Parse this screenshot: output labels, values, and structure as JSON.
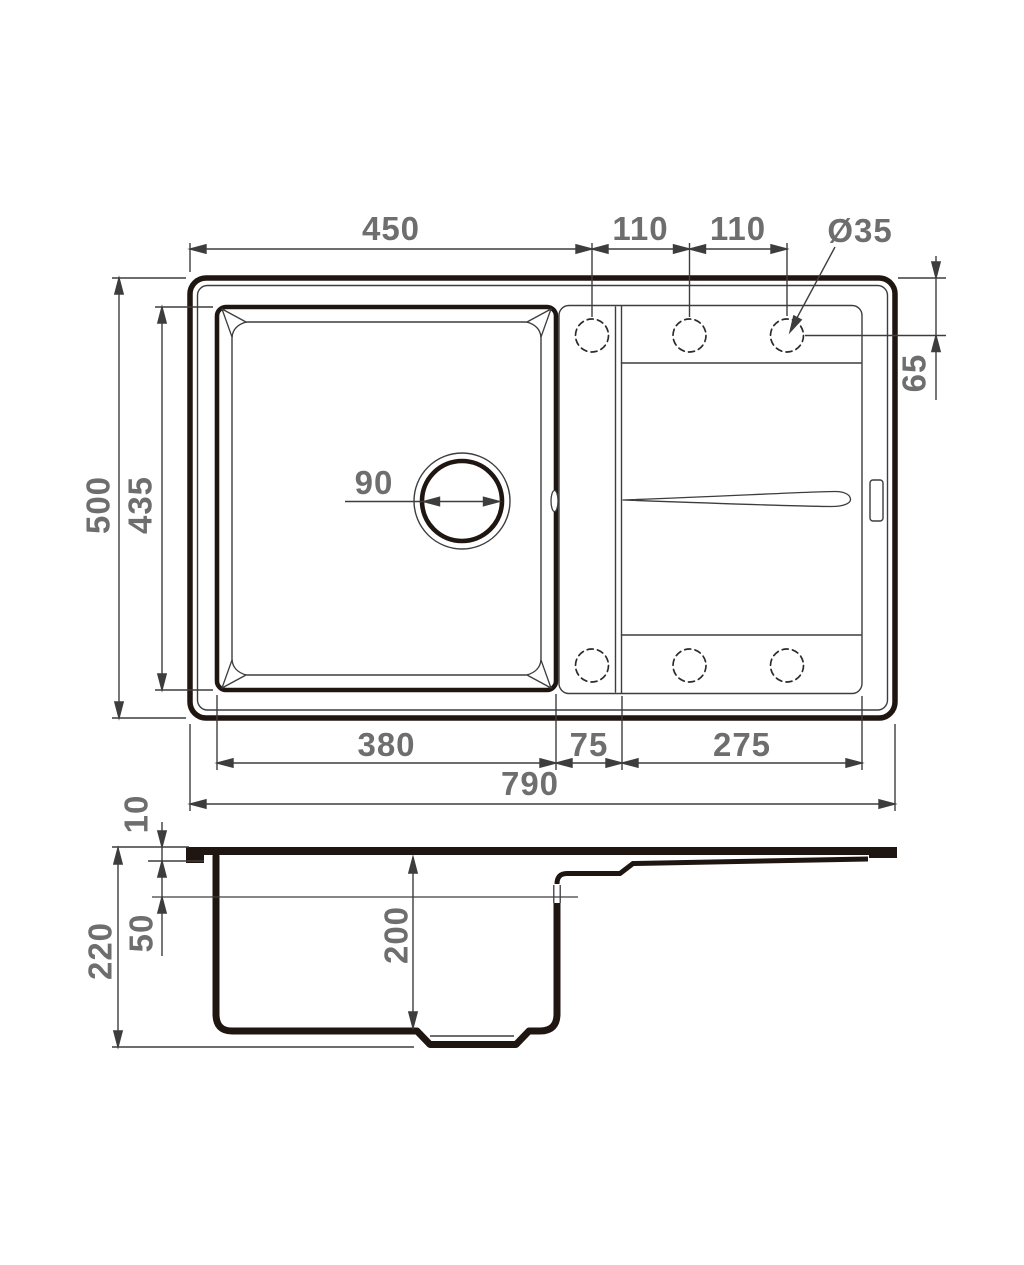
{
  "meta": {
    "type": "technical dimension drawing",
    "subject": "kitchen sink with single bowl and drainboard",
    "views": [
      "top view",
      "side cross-section"
    ],
    "units_implied": "mm"
  },
  "colors": {
    "heavy_line": "#201611",
    "thin_line": "#3d3d3d",
    "dimension_text": "#6e6e6e",
    "background": "#ffffff"
  },
  "labels": {
    "top_450": "450",
    "top_110a": "110",
    "top_110b": "110",
    "hole_dia": "Ø35",
    "side_65": "65",
    "left_500": "500",
    "left_435": "435",
    "drain_90": "90",
    "bottom_380": "380",
    "bottom_75": "75",
    "bottom_275": "275",
    "bottom_790": "790",
    "section_10": "10",
    "section_50": "50",
    "section_220": "220",
    "section_200": "200"
  },
  "features": {
    "tap_holes": {
      "count": 6,
      "diameter_label": "Ø35",
      "style": "dashed circles"
    },
    "drain": {
      "diameter_label": "90"
    },
    "overall": {
      "width": "790",
      "depth": "500",
      "height": "220"
    },
    "bowl": {
      "width": "380",
      "depth": "435",
      "bowl_depth": "200"
    }
  }
}
